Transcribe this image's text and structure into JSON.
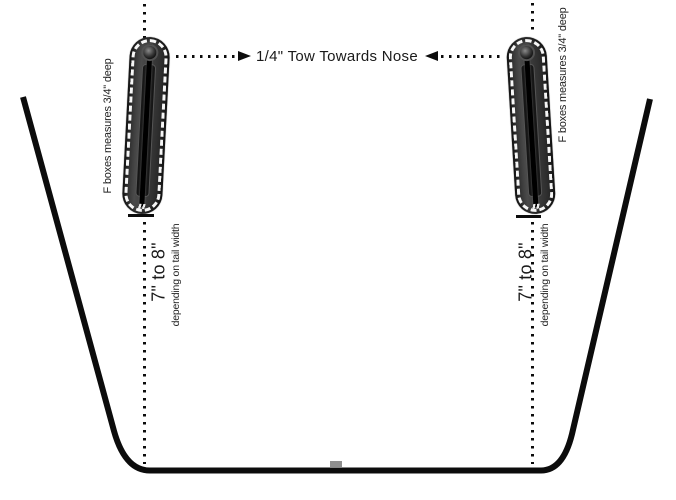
{
  "annotations": {
    "tow_label": "1/4\" Tow Towards Nose",
    "left_box_depth": "F boxes measures 3/4\" deep",
    "right_box_depth": "F boxes measures 3/4\" deep",
    "left_distance": "7\" to 8\"",
    "left_distance_note": "depending on tail width",
    "right_distance": "7\" to 8\"",
    "right_distance_note": "depending on tail width"
  },
  "colors": {
    "line": "#0c0c0c",
    "text": "#1a1a1a",
    "finbox_body": "#3a3a3a",
    "finbox_dash": "#f6f6f6",
    "background": "#ffffff",
    "stringer_mark": "#8f8f8f"
  }
}
